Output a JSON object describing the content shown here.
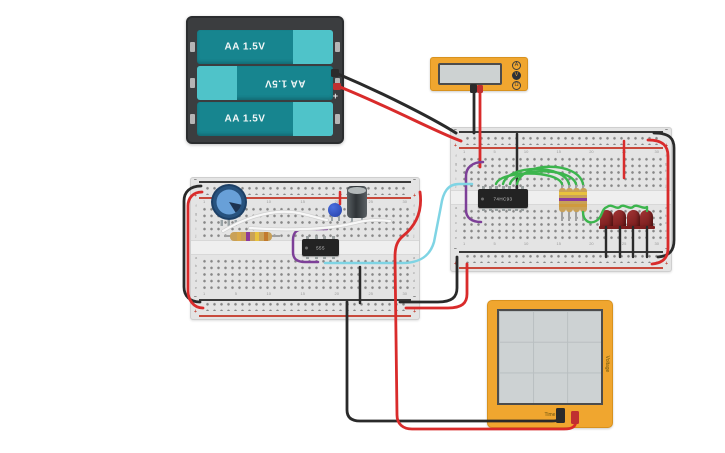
{
  "palette": {
    "red": "#d92b2b",
    "black": "#2a2a2a",
    "green": "#3cb54d",
    "cyan": "#7fd4e4",
    "purple": "#7d3f98",
    "white": "#f7f7f7",
    "device_orange": "#f0a62f",
    "screen_gray": "#cdd2d3",
    "board_gray": "#e4e4e4",
    "led_red": "#8e2424"
  },
  "battery_pack": {
    "cells": [
      {
        "label": "AA 1.5V",
        "flipped": false
      },
      {
        "label": "AA 1.5V",
        "flipped": true
      },
      {
        "label": "AA 1.5V",
        "flipped": false
      }
    ],
    "terminal_minus": "−",
    "terminal_plus": "+"
  },
  "multimeter": {
    "modes": [
      {
        "label": "A",
        "selected": false
      },
      {
        "label": "V",
        "selected": true
      },
      {
        "label": "Ω",
        "selected": false
      }
    ]
  },
  "oscilloscope": {
    "x_axis_label": "Time",
    "y_axis_label": "Voltage"
  },
  "breadboard_labels": {
    "minus": "−",
    "plus": "+",
    "column_numbers": [
      "1",
      "5",
      "10",
      "15",
      "20",
      "25",
      "30"
    ],
    "row_letters_top": [
      "f",
      "g",
      "h",
      "i",
      "j"
    ],
    "row_letters_bottom": [
      "a",
      "b",
      "c",
      "d",
      "e"
    ]
  },
  "chips": [
    {
      "name": "timer-555-chip",
      "label": "555",
      "x": 302,
      "y": 239,
      "w": 37,
      "h": 17,
      "pins": 4
    },
    {
      "name": "counter-74hc93-chip",
      "label": "74HC93",
      "x": 478,
      "y": 189,
      "w": 50,
      "h": 19,
      "pins": 7
    }
  ],
  "leds": {
    "positions": [
      {
        "x": 600,
        "y": 210
      },
      {
        "x": 613,
        "y": 210
      },
      {
        "x": 627,
        "y": 210
      },
      {
        "x": 640,
        "y": 210
      }
    ]
  },
  "resistors_vertical": {
    "centers": [
      562,
      569,
      576,
      583
    ],
    "lead_top": 182,
    "lead_bottom": 221,
    "body_top": 188,
    "body_h": 24,
    "bands": [
      "#e8c23e",
      "#8d3a9b",
      "#cf9a3e"
    ]
  },
  "resistor_horizontal": {
    "bands": [
      "#d8a84a",
      "#8d3a9b",
      "#e8c23e",
      "#c27a2e"
    ]
  },
  "wires": [
    {
      "name": "battery-wire-black",
      "color": "black",
      "w": 3,
      "path": "M338 74 C385 94 432 118 456 133"
    },
    {
      "name": "battery-wire-red",
      "color": "red",
      "w": 3,
      "path": "M340 87 C392 108 436 132 461 141"
    },
    {
      "name": "multimeter-probe-black",
      "color": "black",
      "w": 2.8,
      "path": "M474 92 L474 133"
    },
    {
      "name": "multimeter-probe-red",
      "color": "red",
      "w": 2.8,
      "path": "M480 92 L480 167"
    },
    {
      "name": "ground-jumper-74hc93",
      "color": "black",
      "w": 2.5,
      "path": "M517 134 L517 188"
    },
    {
      "name": "power-jumper-resistors",
      "color": "red",
      "w": 2.5,
      "path": "M624 141 L624 178"
    },
    {
      "name": "purple-hook-74hc93",
      "color": "purple",
      "w": 2.5,
      "path": "M483 162 C472 162 466 168 466 176 L466 210 C466 218 472 222 481 222"
    },
    {
      "name": "clock-wire-cyan",
      "color": "cyan",
      "w": 2.5,
      "path": "M325 263 L402 263 C420 263 430 256 434 242 L441 206 C443 192 448 184 459 184 L472 184"
    },
    {
      "name": "purple-hook-555",
      "color": "purple",
      "w": 2.5,
      "path": "M327 229 L305 229 C296 229 293 233 293 240 L293 252 C293 259 297 262 305 262 L318 262"
    },
    {
      "name": "green-jumper-1",
      "color": "green",
      "w": 2.4,
      "path": "M496 184 C501 170 557 170 562 184"
    },
    {
      "name": "green-jumper-2",
      "color": "green",
      "w": 2.4,
      "path": "M503 184 C508 164 564 164 569 184"
    },
    {
      "name": "green-jumper-3",
      "color": "green",
      "w": 2.4,
      "path": "M510 184 C515 167 571 167 576 184"
    },
    {
      "name": "green-jumper-4",
      "color": "green",
      "w": 2.4,
      "path": "M517 184 C522 161 578 161 583 184"
    },
    {
      "name": "green-led-chain",
      "color": "green",
      "w": 2.4,
      "path": "M583 212 C583 220 589 225 596 221 C603 217 601 209 607 207 C612 203 616 210 620 207 C624 203 629 210 633 207 C637 203 643 210 647 207 L647 211"
    },
    {
      "name": "led-cathode-1",
      "color": "black",
      "w": 2.4,
      "path": "M606 227 L606 257"
    },
    {
      "name": "led-cathode-2",
      "color": "black",
      "w": 2.4,
      "path": "M620 227 L620 257"
    },
    {
      "name": "led-cathode-3",
      "color": "black",
      "w": 2.4,
      "path": "M633 227 L633 257"
    },
    {
      "name": "led-cathode-4",
      "color": "black",
      "w": 2.4,
      "path": "M647 227 L647 257"
    },
    {
      "name": "rail-link-black-right",
      "color": "black",
      "w": 2.8,
      "path": "M654 133 C670 133 674 139 674 148 L674 240 C674 250 670 256 658 257"
    },
    {
      "name": "rail-link-red-right",
      "color": "red",
      "w": 2.8,
      "path": "M648 140 C663 140 668 146 668 156 L668 248 C668 257 664 263 652 264"
    },
    {
      "name": "rail-link-black-left",
      "color": "black",
      "w": 2.8,
      "path": "M201 186 C190 186 184 192 184 201 L184 287 C184 296 190 302 200 302"
    },
    {
      "name": "rail-link-red-left",
      "color": "red",
      "w": 2.8,
      "path": "M202 192 C193 192 188 198 188 206 L188 291 C188 299 193 308 203 308"
    },
    {
      "name": "interboard-ground",
      "color": "black",
      "w": 2.8,
      "path": "M400 302 L438 302 C452 302 457 297 457 288 L457 257"
    },
    {
      "name": "interboard-power",
      "color": "red",
      "w": 2.8,
      "path": "M406 308 L448 308 C462 308 467 303 467 294 L467 264"
    },
    {
      "name": "white-jumper-1",
      "color": "white",
      "w": 2.2,
      "outline": true,
      "path": "M223 231 C243 219 268 210 291 212 C305 213 316 218 327 220"
    },
    {
      "name": "white-jumper-2",
      "color": "white",
      "w": 2.2,
      "outline": true,
      "path": "M250 228 C290 231 330 229 355 223 C370 219 380 220 390 221"
    },
    {
      "name": "ground-jumper-555",
      "color": "black",
      "w": 2.5,
      "path": "M360 267 L360 303"
    },
    {
      "name": "power-jumper-disc",
      "color": "red",
      "w": 2.5,
      "path": "M340 192 L340 204"
    },
    {
      "name": "scope-wire-black",
      "color": "black",
      "w": 2.8,
      "path": "M347 302 L347 410 C347 418 352 421 360 421 L552 421 C558 421 561 420 561 414"
    },
    {
      "name": "scope-wire-red",
      "color": "red",
      "w": 2.8,
      "path": "M420 192 C423 213 414 227 403 236 C397 241 395 247 395 257 L397 415 C397 424 403 429 412 429 L564 429 C572 429 576 427 576 420"
    }
  ],
  "plugs": [
    {
      "name": "battery-plug-black",
      "x": 331,
      "y": 69,
      "w": 8,
      "h": 8,
      "fill": "#2b2b2b"
    },
    {
      "name": "battery-plug-red",
      "x": 333,
      "y": 83,
      "w": 8,
      "h": 7,
      "fill": "#c03030"
    },
    {
      "name": "multimeter-plug-black",
      "x": 470,
      "y": 84,
      "w": 7,
      "h": 9,
      "fill": "#2b2b2b"
    },
    {
      "name": "multimeter-plug-red",
      "x": 477,
      "y": 85,
      "w": 6,
      "h": 8,
      "fill": "#c03030"
    },
    {
      "name": "scope-plug-black",
      "x": 556,
      "y": 408,
      "w": 9,
      "h": 15,
      "fill": "#2b2b2b"
    },
    {
      "name": "scope-plug-red",
      "x": 571,
      "y": 411,
      "w": 8,
      "h": 13,
      "fill": "#c03030"
    }
  ]
}
